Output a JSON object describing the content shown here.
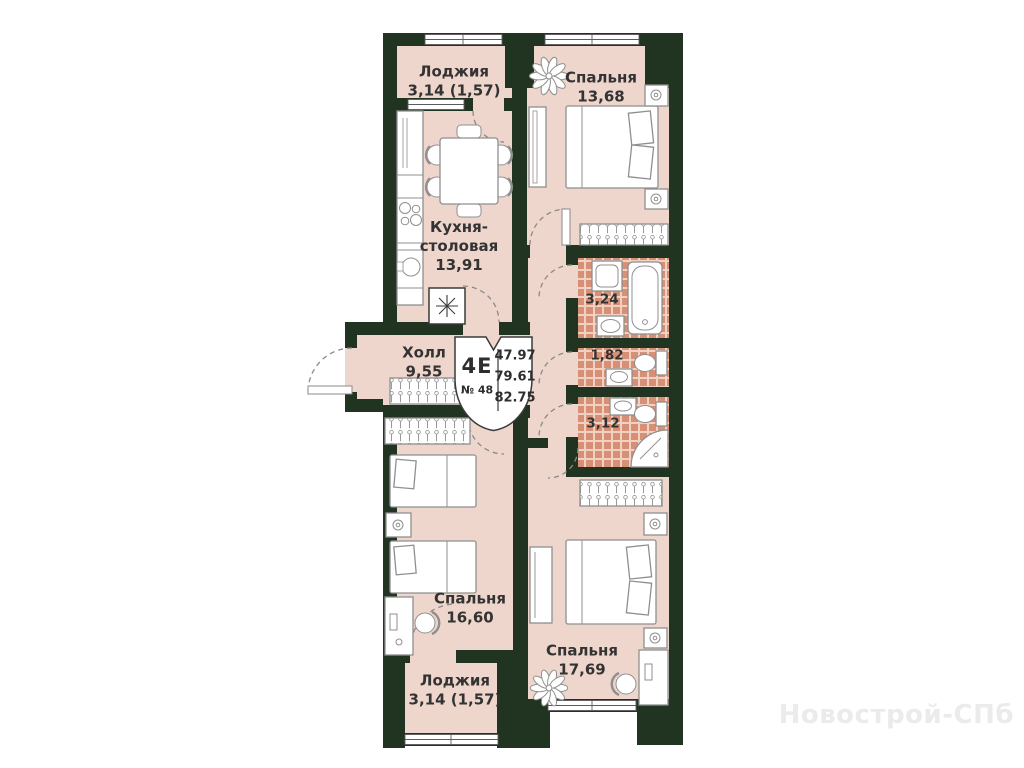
{
  "plan": {
    "badge": {
      "unit_type": "4Е",
      "unit_number": "№ 48",
      "areas": [
        "47.97",
        "79.61",
        "82.75"
      ]
    },
    "rooms": {
      "loggia_top": {
        "name": "Лоджия",
        "area": "3,14 (1,57)"
      },
      "bedroom_top": {
        "name": "Спальня",
        "area": "13,68"
      },
      "kitchen": {
        "name_line1": "Кухня-",
        "name_line2": "столовая",
        "area": "13,91"
      },
      "hall": {
        "name": "Холл",
        "area": "9,55"
      },
      "bathroom": {
        "area": "3,24"
      },
      "wc": {
        "area": "1,82"
      },
      "shower_room": {
        "area": "3,12"
      },
      "bedroom_left": {
        "name": "Спальня",
        "area": "16,60"
      },
      "bedroom_bottom": {
        "name": "Спальня",
        "area": "17,69"
      },
      "loggia_bottom": {
        "name": "Лоджия",
        "area": "3,14 (1,57)"
      }
    },
    "watermark": "Новострой-СПб",
    "colors": {
      "wall": "#213421",
      "floor": "#eed6cc",
      "tile": "#d78f75",
      "tile_grout": "#f1d2c2",
      "furniture_outline": "#8f8f8f",
      "label_text": "#333333",
      "watermark_text": "#ebebeb"
    }
  }
}
